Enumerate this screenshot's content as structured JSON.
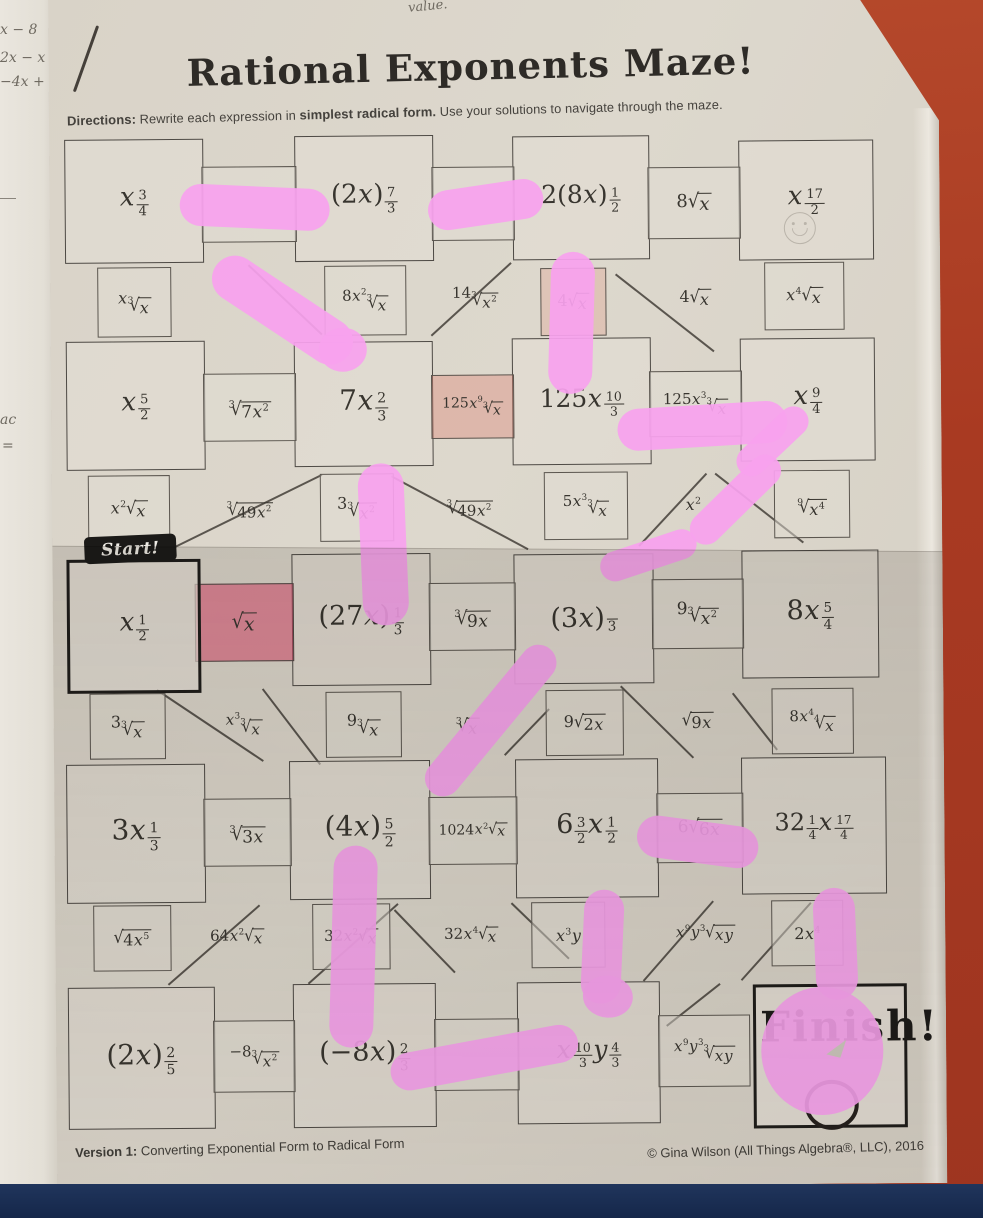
{
  "page": {
    "title": "Rational Exponents Maze!",
    "directions_label": "Directions:",
    "directions_pre": " Rewrite each expression in ",
    "directions_bold": "simplest radical form.",
    "directions_post": " Use your solutions to navigate through the maze.",
    "start_label": "Start!",
    "finish_label": "Finish!",
    "footer_version_label": "Version 1:",
    "footer_version_text": " Converting Exponential Form to Radical Form",
    "footer_copyright": "© Gina Wilson (All Things Algebra®, LLC), 2016"
  },
  "scraps": {
    "top_note": "value.",
    "items": [
      "x − 8",
      "2x − x",
      "−4x +",
      "ac",
      "="
    ]
  },
  "colors": {
    "pink_marker": "#f8a1ee",
    "red_highlight": "#df486e",
    "paper": "#d9d3c8",
    "background_red": "#a93a22",
    "navy_strip": "#1b2c50"
  },
  "maze": {
    "boxes": [
      {
        "x": 63,
        "y": 140,
        "w": 137,
        "h": 122,
        "e": "x^{3/4}"
      },
      {
        "x": 293,
        "y": 138,
        "w": 137,
        "h": 124,
        "e": "(2x)^{7/3}"
      },
      {
        "x": 511,
        "y": 140,
        "w": 135,
        "h": 122,
        "e": "2(8x)^{1/2}",
        "fs": 25
      },
      {
        "x": 737,
        "y": 146,
        "w": 133,
        "h": 118,
        "e": "x^{17/2}"
      },
      {
        "x": 63,
        "y": 342,
        "w": 137,
        "h": 127,
        "e": "x^{5/2}"
      },
      {
        "x": 291,
        "y": 344,
        "w": 137,
        "h": 123,
        "e": "7x^{2/3}",
        "fs": 28
      },
      {
        "x": 509,
        "y": 342,
        "w": 137,
        "h": 125,
        "e": "125x^{10/3}",
        "fs": 25
      },
      {
        "x": 737,
        "y": 344,
        "w": 133,
        "h": 121,
        "e": "x^{9/4}"
      },
      {
        "x": 62,
        "y": 560,
        "w": 128,
        "h": 128,
        "e": "x^{1/2}",
        "thick": true
      },
      {
        "x": 287,
        "y": 556,
        "w": 137,
        "h": 130,
        "e": "(27x)^{1/3}",
        "fs": 27
      },
      {
        "x": 509,
        "y": 558,
        "w": 138,
        "h": 128,
        "e": "(3x)^{/3}",
        "fs": 27
      },
      {
        "x": 737,
        "y": 556,
        "w": 135,
        "h": 126,
        "e": "8x^{5/4}",
        "fs": 27
      },
      {
        "x": 60,
        "y": 765,
        "w": 137,
        "h": 137,
        "e": "3x^{1/3}",
        "fs": 28
      },
      {
        "x": 283,
        "y": 763,
        "w": 139,
        "h": 137,
        "e": "(4x)^{5/2}",
        "fs": 28
      },
      {
        "x": 509,
        "y": 763,
        "w": 141,
        "h": 137,
        "e": "6^{3/2}x^{1/2}",
        "fs": 27
      },
      {
        "x": 735,
        "y": 763,
        "w": 143,
        "h": 135,
        "e": "32^{1/4}x^{17/4}",
        "fs": 24
      },
      {
        "x": 60,
        "y": 988,
        "w": 145,
        "h": 140,
        "e": "(2x)^{2/5}",
        "fs": 28
      },
      {
        "x": 285,
        "y": 986,
        "w": 141,
        "h": 142,
        "e": "(−8x)^{2/3}",
        "fs": 27
      },
      {
        "x": 509,
        "y": 986,
        "w": 141,
        "h": 140,
        "e": "x^{10/3}y^{4/3}",
        "fs": 25
      },
      {
        "x": 745,
        "y": 990,
        "w": 148,
        "h": 138,
        "e": "",
        "thick": true,
        "finish": true
      }
    ],
    "cells": [
      {
        "x": 200,
        "y": 168,
        "w": 93,
        "h": 74,
        "e": ""
      },
      {
        "x": 430,
        "y": 170,
        "w": 81,
        "h": 72,
        "e": ""
      },
      {
        "x": 646,
        "y": 172,
        "w": 91,
        "h": 70,
        "e": "8sqrt{x}",
        "fs": 18
      },
      {
        "x": 200,
        "y": 375,
        "w": 91,
        "h": 66,
        "e": "sqrt[3]{7x^2}",
        "fs": 17
      },
      {
        "x": 428,
        "y": 378,
        "w": 81,
        "h": 62,
        "e": "125x^9sqrt[3]{x}",
        "fs": 14,
        "cls": "tint2"
      },
      {
        "x": 646,
        "y": 376,
        "w": 91,
        "h": 64,
        "e": "125x^3sqrt[3]{x}",
        "fs": 15
      },
      {
        "x": 190,
        "y": 585,
        "w": 97,
        "h": 76,
        "e": "sqrt{x}",
        "fs": 19,
        "cls": "hlred"
      },
      {
        "x": 424,
        "y": 586,
        "w": 85,
        "h": 66,
        "e": "sqrt[3]{9x}",
        "fs": 17
      },
      {
        "x": 647,
        "y": 584,
        "w": 90,
        "h": 68,
        "e": "9sqrt[3]{x^2}",
        "fs": 17
      },
      {
        "x": 197,
        "y": 800,
        "w": 86,
        "h": 66,
        "e": "sqrt[3]{3x}",
        "fs": 17
      },
      {
        "x": 422,
        "y": 800,
        "w": 87,
        "h": 66,
        "e": "1024x^2sqrt{x}",
        "fs": 14
      },
      {
        "x": 650,
        "y": 798,
        "w": 85,
        "h": 68,
        "e": "6sqrt{6x}",
        "fs": 17
      },
      {
        "x": 205,
        "y": 1022,
        "w": 80,
        "h": 70,
        "e": "−8sqrt[3]{x^2}",
        "fs": 15
      },
      {
        "x": 426,
        "y": 1022,
        "w": 83,
        "h": 70,
        "e": ""
      },
      {
        "x": 650,
        "y": 1020,
        "w": 90,
        "h": 70,
        "e": "x^9y^3sqrt[3]{xy}",
        "fs": 15
      },
      {
        "x": 95,
        "y": 268,
        "w": 72,
        "h": 68,
        "e": "xsqrt[3]{x}"
      },
      {
        "x": 322,
        "y": 268,
        "w": 80,
        "h": 68,
        "e": "8x^2sqrt[3]{x}",
        "fs": 15
      },
      {
        "x": 432,
        "y": 266,
        "w": 82,
        "h": 70,
        "e": "14sqrt[3]{x^2}",
        "cls": "nb",
        "fs": 15
      },
      {
        "x": 538,
        "y": 272,
        "w": 64,
        "h": 66,
        "e": "4sqrt{x}",
        "cls": "tint"
      },
      {
        "x": 655,
        "y": 270,
        "w": 76,
        "h": 66,
        "e": "4sqrt{x}",
        "cls": "nb"
      },
      {
        "x": 762,
        "y": 268,
        "w": 78,
        "h": 66,
        "e": "x^4sqrt{x}"
      },
      {
        "x": 84,
        "y": 476,
        "w": 80,
        "h": 66,
        "e": "x^2sqrt{x}"
      },
      {
        "x": 205,
        "y": 476,
        "w": 82,
        "h": 66,
        "e": "sqrt[3]{49x^2}",
        "cls": "nb",
        "fs": 15
      },
      {
        "x": 316,
        "y": 476,
        "w": 72,
        "h": 66,
        "e": "3sqrt[3]{x^2}"
      },
      {
        "x": 426,
        "y": 476,
        "w": 80,
        "h": 66,
        "e": "sqrt[3]{49x^2}",
        "cls": "nb",
        "fs": 15
      },
      {
        "x": 540,
        "y": 476,
        "w": 82,
        "h": 66,
        "e": "5x^3sqrt[3]{x}",
        "fs": 15
      },
      {
        "x": 652,
        "y": 476,
        "w": 74,
        "h": 66,
        "e": "x^2",
        "cls": "nb"
      },
      {
        "x": 770,
        "y": 476,
        "w": 74,
        "h": 66,
        "e": "sqrt[9]{x^4}"
      },
      {
        "x": 84,
        "y": 694,
        "w": 74,
        "h": 64,
        "e": "3sqrt[3]{x}"
      },
      {
        "x": 200,
        "y": 694,
        "w": 76,
        "h": 64,
        "e": "x^3sqrt[3]{x}",
        "cls": "nb",
        "fs": 15
      },
      {
        "x": 320,
        "y": 694,
        "w": 74,
        "h": 64,
        "e": "9sqrt[3]{x}"
      },
      {
        "x": 432,
        "y": 694,
        "w": 60,
        "h": 64,
        "e": "sqrt[3]{x}",
        "cls": "nb"
      },
      {
        "x": 540,
        "y": 694,
        "w": 76,
        "h": 64,
        "e": "9sqrt{2x}"
      },
      {
        "x": 655,
        "y": 694,
        "w": 74,
        "h": 64,
        "e": "sqrt{9x}",
        "cls": "nb"
      },
      {
        "x": 766,
        "y": 694,
        "w": 80,
        "h": 64,
        "e": "8x^4sqrt[4]{x}",
        "fs": 15
      },
      {
        "x": 86,
        "y": 906,
        "w": 76,
        "h": 64,
        "e": "sqrt{4x^5}"
      },
      {
        "x": 190,
        "y": 906,
        "w": 80,
        "h": 64,
        "e": "64x^2sqrt{x}",
        "cls": "nb",
        "fs": 15
      },
      {
        "x": 305,
        "y": 906,
        "w": 76,
        "h": 64,
        "e": "32x^2sqrt{x}",
        "fs": 15
      },
      {
        "x": 424,
        "y": 906,
        "w": 80,
        "h": 64,
        "e": "32x^4sqrt{x}",
        "cls": "nb",
        "fs": 15
      },
      {
        "x": 524,
        "y": 906,
        "w": 72,
        "h": 64,
        "e": "x^3y"
      },
      {
        "x": 655,
        "y": 906,
        "w": 86,
        "h": 64,
        "e": "x^9y^3sqrt{xy}",
        "cls": "nb",
        "fs": 15
      },
      {
        "x": 764,
        "y": 906,
        "w": 70,
        "h": 64,
        "e": "2x^4"
      }
    ],
    "diagonals": [
      [
        247,
        266,
        320,
        336
      ],
      [
        428,
        338,
        508,
        266
      ],
      [
        614,
        278,
        712,
        356
      ],
      [
        160,
        552,
        318,
        476
      ],
      [
        388,
        478,
        524,
        552
      ],
      [
        634,
        550,
        702,
        478
      ],
      [
        712,
        478,
        800,
        548
      ],
      [
        152,
        690,
        258,
        762
      ],
      [
        258,
        690,
        315,
        766
      ],
      [
        498,
        758,
        543,
        712
      ],
      [
        616,
        690,
        688,
        762
      ],
      [
        728,
        698,
        772,
        755
      ],
      [
        160,
        985,
        252,
        906
      ],
      [
        300,
        985,
        390,
        906
      ],
      [
        388,
        912,
        448,
        975
      ],
      [
        505,
        906,
        562,
        962
      ],
      [
        635,
        985,
        705,
        906
      ],
      [
        733,
        985,
        803,
        908
      ],
      [
        658,
        1030,
        712,
        988
      ]
    ],
    "pink_strokes": [
      {
        "x": 178,
        "y": 188,
        "w": 150,
        "h": 42,
        "rot": 3
      },
      {
        "x": 426,
        "y": 188,
        "w": 116,
        "h": 40,
        "rot": -8
      },
      {
        "x": 200,
        "y": 289,
        "w": 160,
        "h": 46,
        "rot": 34
      },
      {
        "x": 316,
        "y": 330,
        "w": 48,
        "h": 44,
        "rot": 0,
        "round": true
      },
      {
        "x": 547,
        "y": 256,
        "w": 44,
        "h": 142,
        "rot": 2
      },
      {
        "x": 614,
        "y": 410,
        "w": 170,
        "h": 42,
        "rot": -3
      },
      {
        "x": 594,
        "y": 545,
        "w": 100,
        "h": 30,
        "rot": -18
      },
      {
        "x": 674,
        "y": 489,
        "w": 115,
        "h": 32,
        "rot": -44
      },
      {
        "x": 725,
        "y": 432,
        "w": 88,
        "h": 30,
        "rot": -43
      },
      {
        "x": 356,
        "y": 466,
        "w": 46,
        "h": 162,
        "rot": -2
      },
      {
        "x": 392,
        "y": 706,
        "w": 186,
        "h": 36,
        "rot": -50
      },
      {
        "x": 324,
        "y": 848,
        "w": 44,
        "h": 202,
        "rot": 2
      },
      {
        "x": 630,
        "y": 826,
        "w": 122,
        "h": 42,
        "rot": 8
      },
      {
        "x": 575,
        "y": 894,
        "w": 40,
        "h": 114,
        "rot": 3
      },
      {
        "x": 807,
        "y": 894,
        "w": 42,
        "h": 112,
        "rot": -2
      },
      {
        "x": 753,
        "y": 993,
        "w": 122,
        "h": 128,
        "rot": 0,
        "round": true
      },
      {
        "x": 381,
        "y": 1042,
        "w": 190,
        "h": 38,
        "rot": -10
      },
      {
        "x": 575,
        "y": 980,
        "w": 50,
        "h": 42,
        "rot": 6,
        "round": true
      }
    ]
  }
}
